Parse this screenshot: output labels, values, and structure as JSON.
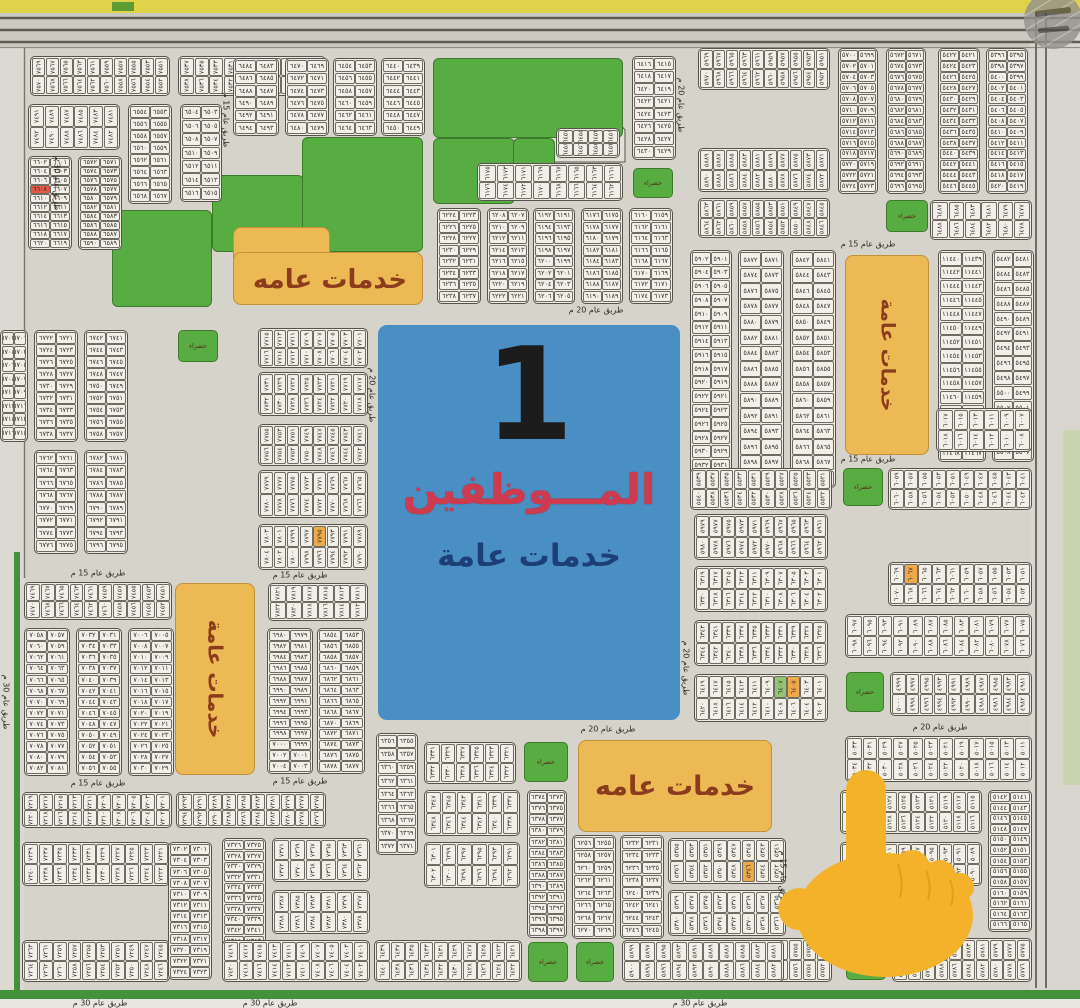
{
  "colors": {
    "map_bg": "#d6d3cb",
    "block_fill": "#edeae3",
    "block_border": "#57544b",
    "green": "#58ad42",
    "green_border": "#3d7a2c",
    "orange": "#ecb955",
    "orange_border": "#c2913a",
    "orange_text": "#8a3c1c",
    "blue": "#4a8fc3",
    "blue_title_red": "#cf3b4e",
    "blue_sub_navy": "#1d3f77",
    "highlight_red": "#e2574a",
    "highlight_orange": "#efa94a",
    "highlight_green": "#96c474",
    "top_strip_yellow": "#ded34a",
    "road_band": "#ccc9c1",
    "bottom_green_bar": "#44913b",
    "hand_yellow": "#f3b229"
  },
  "labels": {
    "road20": "طريق عام 20 م",
    "road15": "طريق عام 15 م",
    "road30": "طريق عام 30 م",
    "green_square": "خضراء",
    "services_a": "خدمات عامه",
    "services_b": "خدمات عامة"
  },
  "center_block": {
    "number": "1",
    "title": "المـــوظفين",
    "subtitle": "خدمات عامة"
  },
  "green_zones": [
    [
      112,
      210,
      100,
      97
    ],
    [
      212,
      175,
      92,
      77
    ],
    [
      302,
      137,
      121,
      115
    ],
    [
      433,
      58,
      190,
      80
    ],
    [
      433,
      138,
      82,
      66
    ],
    [
      513,
      138,
      42,
      38
    ]
  ],
  "green_squares": [
    [
      633,
      168,
      40,
      30
    ],
    [
      886,
      200,
      42,
      32
    ],
    [
      843,
      468,
      40,
      38
    ],
    [
      846,
      672,
      38,
      40
    ],
    [
      846,
      940,
      40,
      40
    ],
    [
      524,
      742,
      44,
      40
    ],
    [
      528,
      942,
      40,
      40
    ],
    [
      576,
      942,
      38,
      40
    ],
    [
      178,
      330,
      40,
      32
    ]
  ],
  "service_zones": [
    {
      "x": 233,
      "y": 227,
      "w": 97,
      "h": 78,
      "label": "",
      "vert": false,
      "fs": 0
    },
    {
      "x": 233,
      "y": 252,
      "w": 190,
      "h": 53,
      "label": "",
      "vert": false,
      "fs": 0
    },
    {
      "x": 175,
      "y": 583,
      "w": 80,
      "h": 192,
      "label": "services_b",
      "vert": true,
      "fs": 20
    },
    {
      "x": 845,
      "y": 255,
      "w": 84,
      "h": 200,
      "label": "services_b",
      "vert": true,
      "fs": 19
    },
    {
      "x": 578,
      "y": 740,
      "w": 194,
      "h": 92,
      "label": "services_a",
      "vert": false,
      "fs": 27
    }
  ],
  "service_label_1": {
    "label": "services_a",
    "x": 330,
    "y": 280,
    "fs": 26
  },
  "road_labels": [
    [
      "road20",
      596,
      310,
      0
    ],
    [
      "road20",
      608,
      729,
      0
    ],
    [
      "road20",
      940,
      727,
      0
    ],
    [
      "road20",
      372,
      395,
      1
    ],
    [
      "road20",
      686,
      668,
      1
    ],
    [
      "road20",
      681,
      105,
      1
    ],
    [
      "road15",
      226,
      120,
      1
    ],
    [
      "road15",
      868,
      244,
      0
    ],
    [
      "road15",
      868,
      459,
      0
    ],
    [
      "road15",
      300,
      575,
      0
    ],
    [
      "road15",
      98,
      573,
      0
    ],
    [
      "road15",
      98,
      783,
      0
    ],
    [
      "road15",
      300,
      781,
      0
    ],
    [
      "road15",
      783,
      878,
      1
    ],
    [
      "road30",
      57,
      183,
      1
    ],
    [
      "road30",
      6,
      702,
      1
    ],
    [
      "road30",
      100,
      1003,
      0
    ],
    [
      "road30",
      270,
      1003,
      0
    ],
    [
      "road30",
      700,
      1003,
      0
    ]
  ],
  "blocks": [
    [
      30,
      56,
      140,
      40,
      1,
      7551,
      20
    ],
    [
      178,
      56,
      148,
      40,
      1,
      7519,
      20
    ],
    [
      28,
      104,
      92,
      46,
      1,
      7481,
      12
    ],
    [
      128,
      104,
      44,
      100,
      0,
      6553,
      16
    ],
    [
      180,
      104,
      42,
      98,
      0,
      6503,
      14
    ],
    [
      28,
      156,
      44,
      94,
      0,
      6601,
      20,
      [
        [
          7,
          "r"
        ]
      ]
    ],
    [
      78,
      156,
      44,
      94,
      0,
      6571,
      20
    ],
    [
      0,
      330,
      28,
      112,
      0,
      6701,
      16
    ],
    [
      34,
      330,
      44,
      112,
      0,
      6721,
      18
    ],
    [
      84,
      330,
      44,
      112,
      0,
      6741,
      18
    ],
    [
      34,
      450,
      44,
      104,
      0,
      6761,
      16
    ],
    [
      84,
      450,
      44,
      104,
      0,
      6781,
      16
    ],
    [
      24,
      582,
      148,
      38,
      1,
      7451,
      20
    ],
    [
      24,
      628,
      46,
      148,
      0,
      7057,
      26
    ],
    [
      76,
      628,
      46,
      148,
      0,
      7031,
      26
    ],
    [
      128,
      628,
      46,
      148,
      0,
      7005,
      26
    ],
    [
      22,
      792,
      150,
      36,
      1,
      7201,
      20
    ],
    [
      176,
      792,
      150,
      36,
      1,
      7275,
      20
    ],
    [
      22,
      842,
      148,
      44,
      1,
      7221,
      20
    ],
    [
      22,
      940,
      148,
      42,
      1,
      7245,
      20
    ],
    [
      168,
      842,
      44,
      138,
      0,
      7301,
      24
    ],
    [
      233,
      58,
      46,
      78,
      0,
      6483,
      12
    ],
    [
      285,
      58,
      44,
      78,
      0,
      6469,
      12
    ],
    [
      333,
      58,
      44,
      78,
      0,
      6453,
      12
    ],
    [
      381,
      58,
      44,
      78,
      0,
      6439,
      12
    ],
    [
      632,
      56,
      44,
      104,
      0,
      6415,
      16
    ],
    [
      477,
      163,
      146,
      38,
      1,
      6161,
      16
    ],
    [
      437,
      208,
      44,
      96,
      0,
      6223,
      16
    ],
    [
      487,
      208,
      42,
      96,
      0,
      6207,
      16
    ],
    [
      533,
      208,
      42,
      96,
      0,
      6191,
      16
    ],
    [
      581,
      208,
      42,
      96,
      0,
      6175,
      16
    ],
    [
      629,
      208,
      44,
      96,
      0,
      6159,
      16
    ],
    [
      698,
      48,
      132,
      42,
      1,
      5951,
      20
    ],
    [
      838,
      48,
      40,
      146,
      0,
      5699,
      26
    ],
    [
      886,
      48,
      40,
      146,
      0,
      5671,
      26
    ],
    [
      938,
      48,
      42,
      146,
      0,
      5421,
      26
    ],
    [
      986,
      48,
      42,
      146,
      0,
      5395,
      26
    ],
    [
      698,
      148,
      132,
      44,
      1,
      5871,
      20
    ],
    [
      698,
      198,
      132,
      40,
      1,
      5845,
      20
    ],
    [
      930,
      200,
      102,
      40,
      1,
      6477,
      12
    ],
    [
      690,
      250,
      42,
      238,
      0,
      5901,
      34
    ],
    [
      738,
      250,
      46,
      238,
      0,
      5871,
      30
    ],
    [
      790,
      250,
      46,
      238,
      0,
      5841,
      30
    ],
    [
      938,
      250,
      48,
      212,
      0,
      11439,
      30
    ],
    [
      992,
      250,
      42,
      212,
      0,
      5481,
      28
    ],
    [
      936,
      408,
      96,
      44,
      1,
      6007,
      12
    ],
    [
      690,
      468,
      142,
      42,
      1,
      5521,
      20
    ],
    [
      888,
      468,
      144,
      42,
      1,
      6041,
      20
    ],
    [
      694,
      514,
      134,
      46,
      1,
      5961,
      20
    ],
    [
      694,
      566,
      134,
      46,
      1,
      6301,
      20
    ],
    [
      694,
      620,
      134,
      46,
      1,
      6325,
      20
    ],
    [
      694,
      674,
      134,
      48,
      1,
      6401,
      20,
      [
        [
          4,
          "o"
        ],
        [
          6,
          "g"
        ]
      ]
    ],
    [
      888,
      562,
      144,
      44,
      1,
      6051,
      20,
      [
        [
          16,
          "o"
        ]
      ]
    ],
    [
      845,
      614,
      187,
      44,
      1,
      6075,
      24
    ],
    [
      890,
      672,
      142,
      44,
      1,
      4981,
      20
    ],
    [
      845,
      736,
      187,
      46,
      1,
      5011,
      24
    ],
    [
      988,
      790,
      44,
      142,
      0,
      5141,
      26
    ],
    [
      840,
      790,
      142,
      44,
      1,
      5115,
      20
    ],
    [
      840,
      842,
      142,
      44,
      1,
      5089,
      20
    ],
    [
      690,
      938,
      142,
      44,
      1,
      5751,
      20
    ],
    [
      892,
      938,
      140,
      44,
      1,
      5775,
      20
    ],
    [
      376,
      733,
      42,
      122,
      0,
      6355,
      18
    ],
    [
      424,
      742,
      92,
      42,
      1,
      6321,
      12
    ],
    [
      424,
      790,
      96,
      46,
      1,
      6337,
      12
    ],
    [
      424,
      842,
      96,
      46,
      1,
      6291,
      12
    ],
    [
      527,
      790,
      40,
      148,
      0,
      6373,
      26
    ],
    [
      572,
      835,
      44,
      104,
      0,
      6255,
      16
    ],
    [
      620,
      835,
      44,
      104,
      0,
      6231,
      16
    ],
    [
      668,
      838,
      118,
      46,
      1,
      5341,
      16,
      [
        [
          5,
          "o"
        ]
      ]
    ],
    [
      668,
      890,
      118,
      46,
      1,
      5365,
      16
    ],
    [
      374,
      940,
      148,
      42,
      1,
      6421,
      20
    ],
    [
      622,
      940,
      162,
      42,
      1,
      5881,
      20
    ],
    [
      222,
      838,
      44,
      142,
      0,
      7325,
      26
    ],
    [
      272,
      838,
      98,
      44,
      1,
      7361,
      12
    ],
    [
      272,
      890,
      98,
      44,
      1,
      7377,
      12
    ],
    [
      222,
      940,
      148,
      42,
      1,
      7401,
      20
    ],
    [
      258,
      328,
      110,
      40,
      1,
      7701,
      16
    ],
    [
      258,
      372,
      110,
      44,
      1,
      7717,
      16
    ],
    [
      258,
      424,
      110,
      42,
      1,
      7741,
      16
    ],
    [
      258,
      470,
      110,
      48,
      1,
      7765,
      16
    ],
    [
      258,
      524,
      110,
      46,
      1,
      7789,
      16,
      [
        [
          6,
          "o"
        ]
      ]
    ],
    [
      268,
      583,
      100,
      38,
      1,
      7811,
      12
    ],
    [
      267,
      628,
      46,
      146,
      0,
      6979,
      26
    ],
    [
      317,
      628,
      48,
      146,
      0,
      6853,
      26
    ],
    [
      556,
      128,
      64,
      30,
      1,
      6451,
      8
    ]
  ]
}
